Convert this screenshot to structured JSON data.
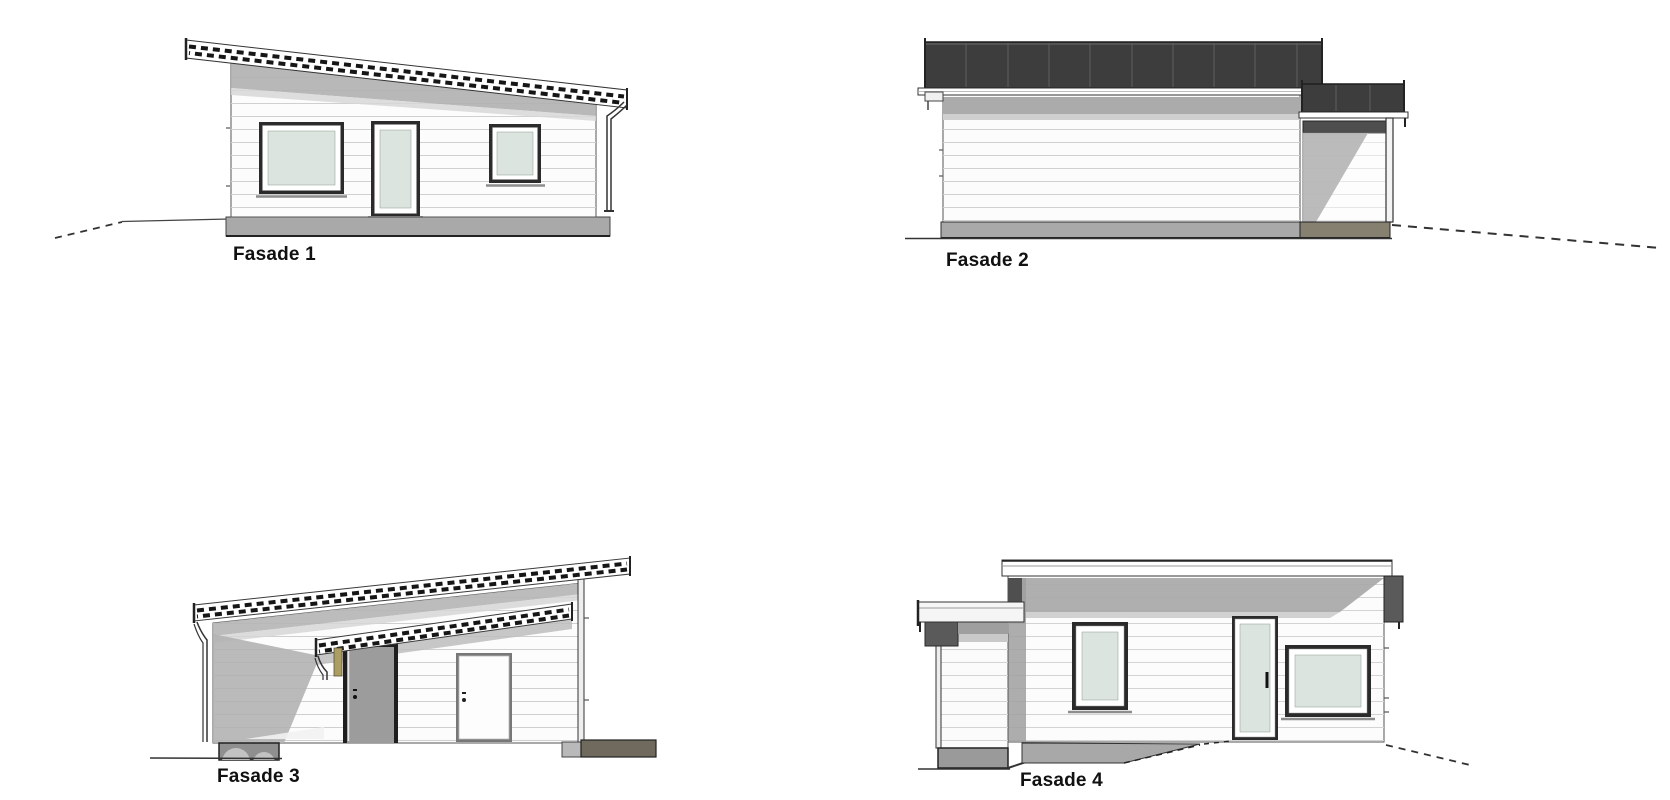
{
  "sheet": {
    "background": "#ffffff",
    "width": 1670,
    "height": 800
  },
  "drawing": {
    "type": "architectural-elevation-sheet",
    "facades": [
      {
        "id": "fasade-1",
        "label": "Fasade 1"
      },
      {
        "id": "fasade-2",
        "label": "Fasade 2"
      },
      {
        "id": "fasade-3",
        "label": "Fasade 3"
      },
      {
        "id": "fasade-4",
        "label": "Fasade 4"
      }
    ],
    "palette": {
      "wall": "#fcfcfc",
      "siding_line": "#d0d0d0",
      "eave_shadow": "#b0b0b0",
      "shadow_light": "#d7d7d7",
      "roof_dark": "#3d3d3d",
      "glass": "#dce4df",
      "frame_dark": "#2b2b2b",
      "door_gray": "#9c9c9c",
      "foundation": "#a9a9a9",
      "foundation_olive": "#837d6f",
      "line": "#333333",
      "label_text": "#111111"
    }
  }
}
